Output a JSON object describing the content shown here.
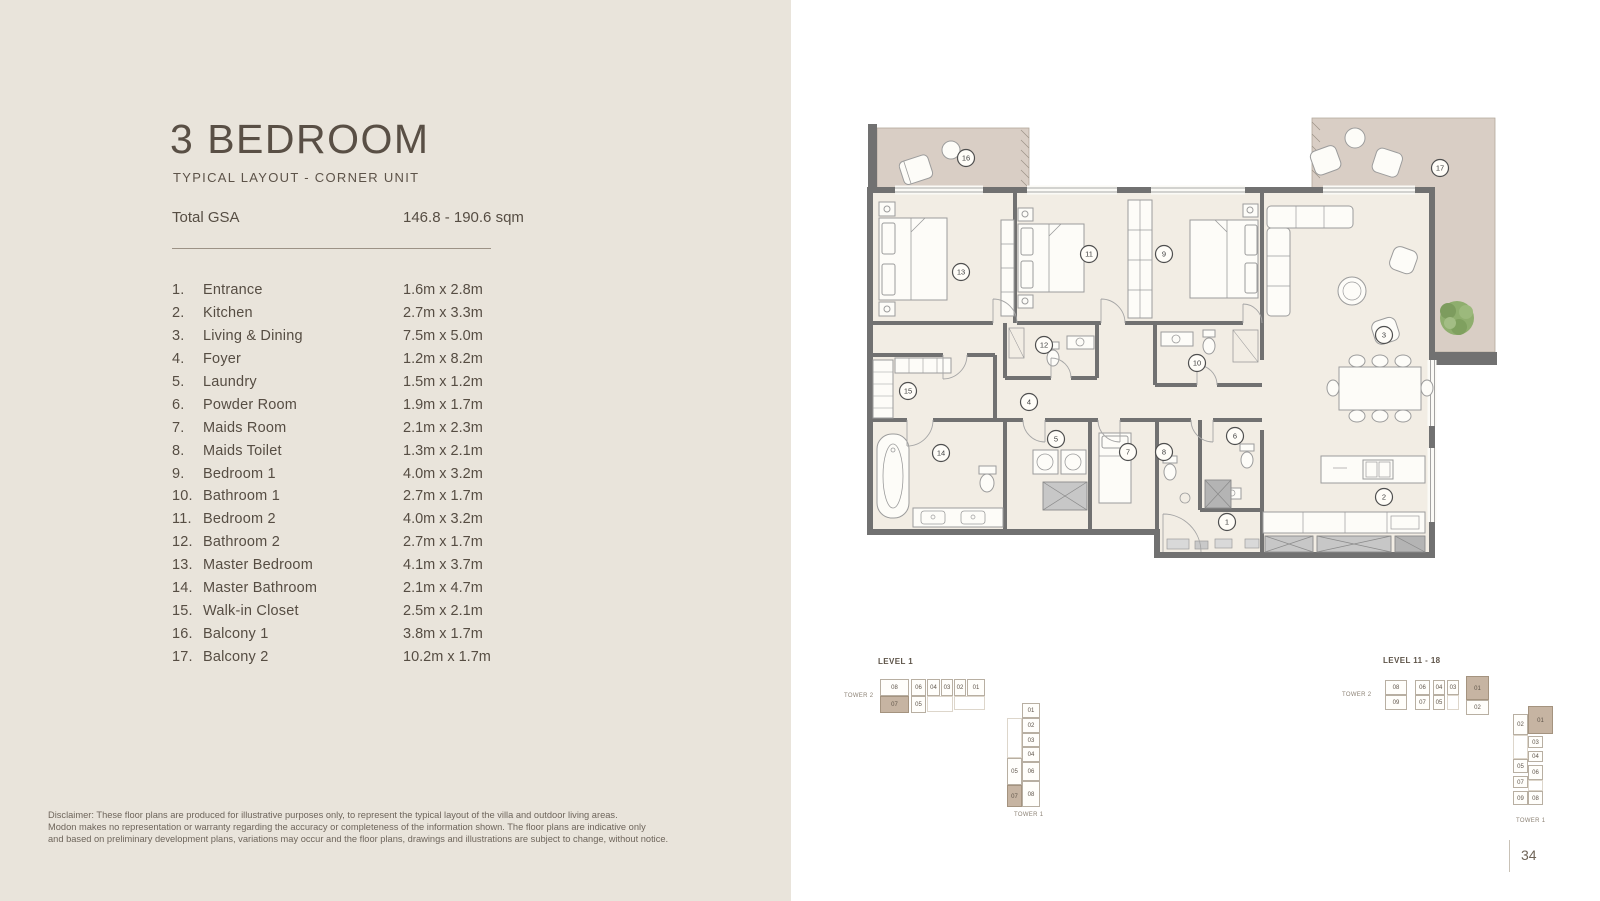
{
  "page": {
    "number": "34"
  },
  "header": {
    "title": "3 BEDROOM",
    "subtitle": "TYPICAL LAYOUT - CORNER UNIT",
    "gsa_label": "Total GSA",
    "gsa_value": "146.8 - 190.6 sqm"
  },
  "rooms": [
    {
      "n": "1.",
      "name": "Entrance",
      "dim": "1.6m x 2.8m"
    },
    {
      "n": "2.",
      "name": "Kitchen",
      "dim": "2.7m x 3.3m"
    },
    {
      "n": "3.",
      "name": "Living & Dining",
      "dim": "7.5m x 5.0m"
    },
    {
      "n": "4.",
      "name": "Foyer",
      "dim": "1.2m x 8.2m"
    },
    {
      "n": "5.",
      "name": "Laundry",
      "dim": "1.5m x 1.2m"
    },
    {
      "n": "6.",
      "name": "Powder Room",
      "dim": "1.9m x 1.7m"
    },
    {
      "n": "7.",
      "name": "Maids Room",
      "dim": "2.1m x 2.3m"
    },
    {
      "n": "8.",
      "name": "Maids Toilet",
      "dim": "1.3m x 2.1m"
    },
    {
      "n": "9.",
      "name": "Bedroom 1",
      "dim": "4.0m x 3.2m"
    },
    {
      "n": "10.",
      "name": "Bathroom 1",
      "dim": "2.7m x 1.7m"
    },
    {
      "n": "11.",
      "name": "Bedroom 2",
      "dim": "4.0m x 3.2m"
    },
    {
      "n": "12.",
      "name": "Bathroom 2",
      "dim": "2.7m x 1.7m"
    },
    {
      "n": "13.",
      "name": "Master Bedroom",
      "dim": "4.1m x 3.7m"
    },
    {
      "n": "14.",
      "name": "Master Bathroom",
      "dim": "2.1m x 4.7m"
    },
    {
      "n": "15.",
      "name": "Walk-in Closet",
      "dim": "2.5m x 2.1m"
    },
    {
      "n": "16.",
      "name": "Balcony 1",
      "dim": "3.8m x 1.7m"
    },
    {
      "n": "17.",
      "name": "Balcony 2",
      "dim": "10.2m x 1.7m"
    }
  ],
  "disclaimer": "Disclaimer: These floor plans are produced for illustrative purposes only, to represent the typical layout of the villa and outdoor living areas.\nModon makes no representation or warranty regarding the accuracy or completeness of the information shown. The floor plans are indicative only\nand based on preliminary development plans, variations may occur and the floor plans, drawings and illustrations are subject to change, without notice.",
  "plan": {
    "markers": [
      {
        "n": "1",
        "x": 372,
        "y": 414
      },
      {
        "n": "2",
        "x": 529,
        "y": 389
      },
      {
        "n": "3",
        "x": 529,
        "y": 227
      },
      {
        "n": "4",
        "x": 174,
        "y": 294
      },
      {
        "n": "5",
        "x": 201,
        "y": 331
      },
      {
        "n": "6",
        "x": 380,
        "y": 328
      },
      {
        "n": "7",
        "x": 273,
        "y": 344
      },
      {
        "n": "8",
        "x": 309,
        "y": 344
      },
      {
        "n": "9",
        "x": 309,
        "y": 146
      },
      {
        "n": "10",
        "x": 342,
        "y": 255
      },
      {
        "n": "11",
        "x": 234,
        "y": 146
      },
      {
        "n": "12",
        "x": 189,
        "y": 237
      },
      {
        "n": "13",
        "x": 106,
        "y": 164
      },
      {
        "n": "14",
        "x": 86,
        "y": 345
      },
      {
        "n": "15",
        "x": 53,
        "y": 283
      },
      {
        "n": "16",
        "x": 111,
        "y": 50
      },
      {
        "n": "17",
        "x": 585,
        "y": 60
      }
    ]
  },
  "keyplans": [
    {
      "title": "LEVEL 1",
      "title_pos": [
        48,
        17
      ],
      "tower2_label": "TOWER 2",
      "tower2_pos": [
        14,
        53
      ],
      "tower1_label": "TOWER 1",
      "tower1_pos": [
        184,
        172
      ],
      "cells": [
        {
          "l": "08",
          "x": 50,
          "y": 39,
          "w": 29,
          "h": 17
        },
        {
          "l": "06",
          "x": 81,
          "y": 39,
          "w": 15,
          "h": 17
        },
        {
          "l": "04",
          "x": 97,
          "y": 39,
          "w": 13,
          "h": 17
        },
        {
          "l": "03",
          "x": 111,
          "y": 39,
          "w": 12,
          "h": 17
        },
        {
          "l": "02",
          "x": 124,
          "y": 39,
          "w": 12,
          "h": 17
        },
        {
          "l": "01",
          "x": 137,
          "y": 39,
          "w": 18,
          "h": 17
        },
        {
          "l": "07",
          "x": 50,
          "y": 56,
          "w": 29,
          "h": 17,
          "hl": true
        },
        {
          "l": "05",
          "x": 81,
          "y": 56,
          "w": 15,
          "h": 17
        },
        {
          "l": "",
          "x": 97,
          "y": 56,
          "w": 26,
          "h": 16,
          "ghost": true
        },
        {
          "l": "",
          "x": 124,
          "y": 56,
          "w": 31,
          "h": 14,
          "ghost": true
        },
        {
          "l": "01",
          "x": 192,
          "y": 63,
          "w": 18,
          "h": 15
        },
        {
          "l": "02",
          "x": 192,
          "y": 78,
          "w": 18,
          "h": 15
        },
        {
          "l": "03",
          "x": 192,
          "y": 93,
          "w": 18,
          "h": 14
        },
        {
          "l": "04",
          "x": 192,
          "y": 107,
          "w": 18,
          "h": 15
        },
        {
          "l": "06",
          "x": 192,
          "y": 122,
          "w": 18,
          "h": 19
        },
        {
          "l": "08",
          "x": 192,
          "y": 141,
          "w": 18,
          "h": 26
        },
        {
          "l": "",
          "x": 177,
          "y": 78,
          "w": 15,
          "h": 40,
          "ghost": true
        },
        {
          "l": "05",
          "x": 177,
          "y": 118,
          "w": 15,
          "h": 27
        },
        {
          "l": "07",
          "x": 177,
          "y": 145,
          "w": 15,
          "h": 22,
          "hl": true
        }
      ]
    },
    {
      "title": "LEVEL 11 - 18",
      "title_pos": [
        53,
        16
      ],
      "tower2_label": "TOWER 2",
      "tower2_pos": [
        12,
        52
      ],
      "tower1_label": "TOWER 1",
      "tower1_pos": [
        186,
        178
      ],
      "cells": [
        {
          "l": "08",
          "x": 55,
          "y": 40,
          "w": 22,
          "h": 15
        },
        {
          "l": "06",
          "x": 85,
          "y": 40,
          "w": 15,
          "h": 15
        },
        {
          "l": "04",
          "x": 103,
          "y": 40,
          "w": 12,
          "h": 15
        },
        {
          "l": "03",
          "x": 117,
          "y": 40,
          "w": 12,
          "h": 15
        },
        {
          "l": "01",
          "x": 136,
          "y": 36,
          "w": 23,
          "h": 24,
          "hl": true
        },
        {
          "l": "09",
          "x": 55,
          "y": 55,
          "w": 22,
          "h": 15
        },
        {
          "l": "07",
          "x": 85,
          "y": 55,
          "w": 15,
          "h": 15
        },
        {
          "l": "05",
          "x": 103,
          "y": 55,
          "w": 12,
          "h": 15
        },
        {
          "l": "",
          "x": 117,
          "y": 55,
          "w": 12,
          "h": 15,
          "ghost": true
        },
        {
          "l": "02",
          "x": 136,
          "y": 60,
          "w": 23,
          "h": 15
        },
        {
          "l": "01",
          "x": 198,
          "y": 66,
          "w": 25,
          "h": 28,
          "hl": true
        },
        {
          "l": "02",
          "x": 183,
          "y": 74,
          "w": 15,
          "h": 21
        },
        {
          "l": "03",
          "x": 198,
          "y": 96,
          "w": 15,
          "h": 12
        },
        {
          "l": "04",
          "x": 198,
          "y": 111,
          "w": 15,
          "h": 11
        },
        {
          "l": "05",
          "x": 183,
          "y": 119,
          "w": 15,
          "h": 14
        },
        {
          "l": "06",
          "x": 198,
          "y": 125,
          "w": 15,
          "h": 15
        },
        {
          "l": "07",
          "x": 183,
          "y": 136,
          "w": 15,
          "h": 12
        },
        {
          "l": "08",
          "x": 198,
          "y": 151,
          "w": 15,
          "h": 14
        },
        {
          "l": "09",
          "x": 183,
          "y": 151,
          "w": 15,
          "h": 14
        },
        {
          "l": "",
          "x": 183,
          "y": 95,
          "w": 15,
          "h": 24,
          "ghost": true
        },
        {
          "l": "",
          "x": 198,
          "y": 140,
          "w": 15,
          "h": 11,
          "ghost": true
        }
      ]
    }
  ]
}
